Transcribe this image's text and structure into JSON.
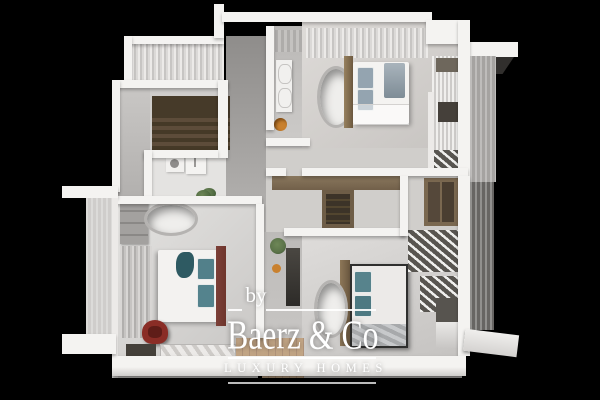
{
  "watermark": {
    "prefix": "by",
    "brand": "Baerz & Co",
    "tagline": "LUXURY HOMES"
  },
  "palette": {
    "bg": "#000000",
    "wall": "#f4f3f1",
    "floor": "#d6d4d2",
    "stair-wood": "#463a29",
    "closet-wood": "#7a6850",
    "accent-orange": "#c9812f",
    "pillow-teal": "#52808a",
    "pillow-blue": "#94a4b0",
    "maroon": "#6e352c",
    "chair-red": "#8a2d26",
    "plant": "#5a7248",
    "wm": "#ffffff"
  }
}
